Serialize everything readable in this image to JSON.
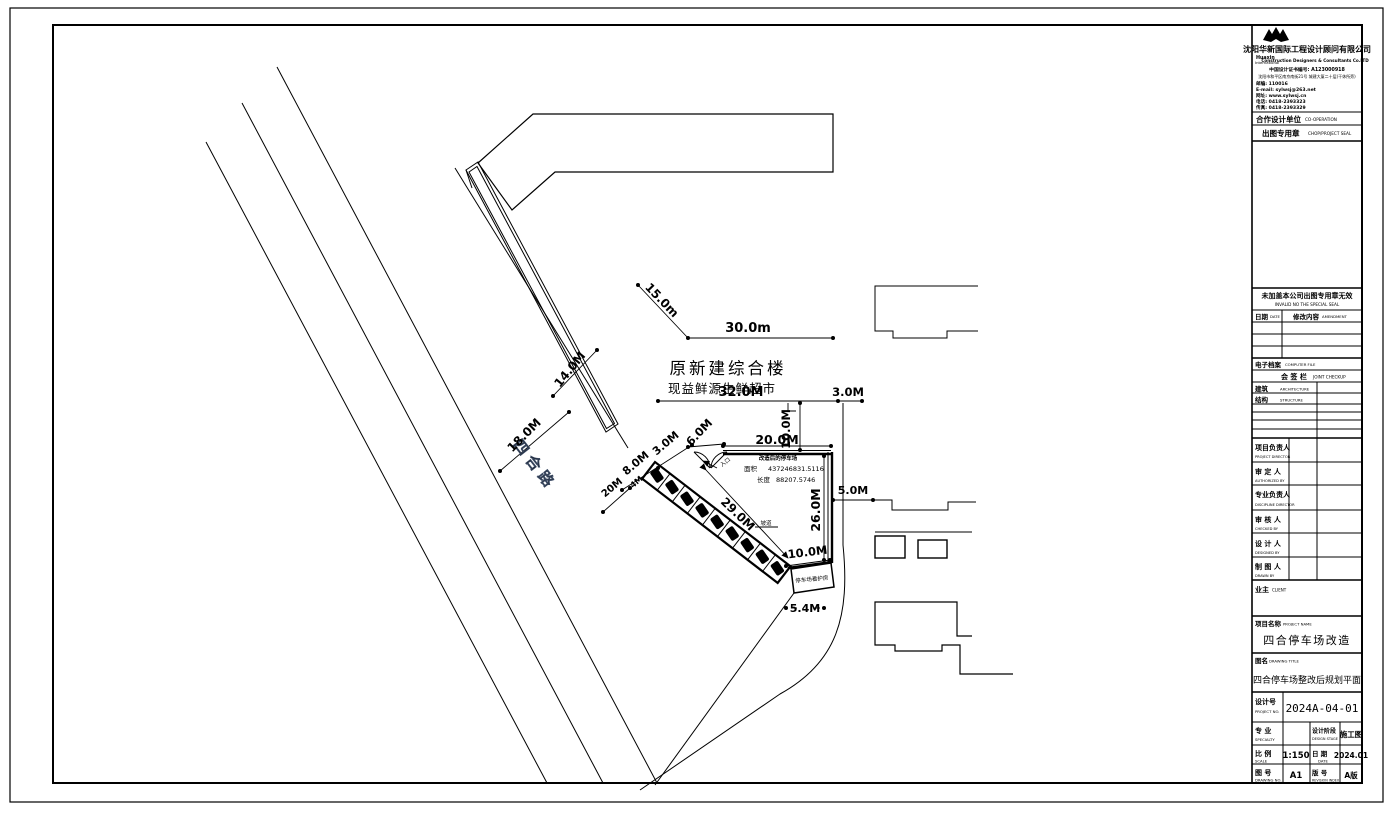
{
  "sheet": {
    "company": {
      "name_cn": "沈阳华新国际工程设计顾问有限公司",
      "en_left1": "Huaxin",
      "en_left2": "International",
      "name_en": "Construction Designers & Consultants Co.LTD",
      "cert": "中国设计证书编号: A123000918",
      "address": "沈阳市和平区南京南街21号 城建大厦二十层(干休所旁)",
      "zip": "邮编: 110016",
      "email": "E-mail: sylwsj@263.net",
      "web": "网址: www.sylwsj.cn",
      "tel": "电话: 0418-2393323",
      "fax": "传真: 0418-2393329"
    },
    "cooperation": {
      "cn": "合作设计单位",
      "en": "CO-OPERATION"
    },
    "seal_row": {
      "cn": "出图专用章",
      "en": "CHOP/PROJECT SEAL"
    },
    "invalid": {
      "cn": "未加盖本公司出图专用章无效",
      "en": "INVALID NO THE SPECIAL SEAL"
    },
    "rev_table": {
      "date_cn": "日期",
      "date_en": "DATE",
      "amend_cn": "修改内容",
      "amend_en": "AMENDMENT"
    },
    "efile": {
      "cn": "电子档案",
      "en": "COMPUTER FILE"
    },
    "joint": {
      "cn": "会 签 栏",
      "en": "JOINT CHECKUP"
    },
    "arch": {
      "cn": "建筑",
      "en": "ARCHITECTURE"
    },
    "struct": {
      "cn": "结构",
      "en": "STRUCTURE"
    },
    "personnel": [
      {
        "cn": "项目负责人",
        "en": "PROJECT DIRECTOR"
      },
      {
        "cn": "审 定 人",
        "en": "AUTHORIZED BY"
      },
      {
        "cn": "专业负责人",
        "en": "DISCIPLINE DIRECTOR"
      },
      {
        "cn": "审 核 人",
        "en": "CHECKED BY"
      },
      {
        "cn": "设 计 人",
        "en": "DESIGNED BY"
      },
      {
        "cn": "制 图 人",
        "en": "DRAWN BY"
      }
    ],
    "client": {
      "cn": "业主",
      "en": "CLIENT"
    },
    "project": {
      "label_cn": "项目名称",
      "label_en": "PROJECT NAME",
      "value": "四合停车场改造"
    },
    "drawing_title": {
      "label_cn": "图名",
      "label_en": "DRAWING TITLE",
      "value": "四合停车场整改后规划平面"
    },
    "design_no": {
      "label_cn": "设计号",
      "label_en": "PROJECT NO.",
      "value": "2024A-04-01"
    },
    "specialty": {
      "label_cn": "专 业",
      "label_en": "SPECIALTY",
      "value": ""
    },
    "stage": {
      "label_cn": "设计阶段",
      "label_en": "DESIGN STAGE",
      "value": "施工图"
    },
    "scale": {
      "label_cn": "比 例",
      "label_en": "SCALE",
      "value": "1:150"
    },
    "date": {
      "label_cn": "日 期",
      "label_en": "DATE",
      "value": "2024.01"
    },
    "dwg_no": {
      "label_cn": "图 号",
      "label_en": "DRAWING NO.",
      "value": "A1"
    },
    "rev": {
      "label_cn": "版 号",
      "label_en": "REVISION INDEX",
      "value": "A版"
    }
  },
  "plan": {
    "building_label1": "原新建综合楼",
    "building_label2": "现益鲜源生鲜超市",
    "road_name": "四合路",
    "lot_header": "改造后的停车场",
    "area_label": "面积",
    "area_value": "437246831.5116",
    "len_label": "长度",
    "len_value": "88207.5746",
    "guard_house": "停车场看护房",
    "entrance": "入口",
    "ramp": "坡道",
    "dims": {
      "d15": "15.0m",
      "d30": "30.0m",
      "d32": "32.0M",
      "d3": "3.0M",
      "d10t": "10.0M",
      "d14": "14.0M",
      "d18": "18.0M",
      "d6": "6.0M",
      "d20": "20.0M",
      "d8": "8.0M",
      "d3b": "3.0M",
      "d20b": "20M",
      "d4": "4M",
      "d29": "29.0M",
      "d26": "26.0M",
      "d10b": "10.0M",
      "d5": "5.0M",
      "d54": "5.4M"
    }
  }
}
